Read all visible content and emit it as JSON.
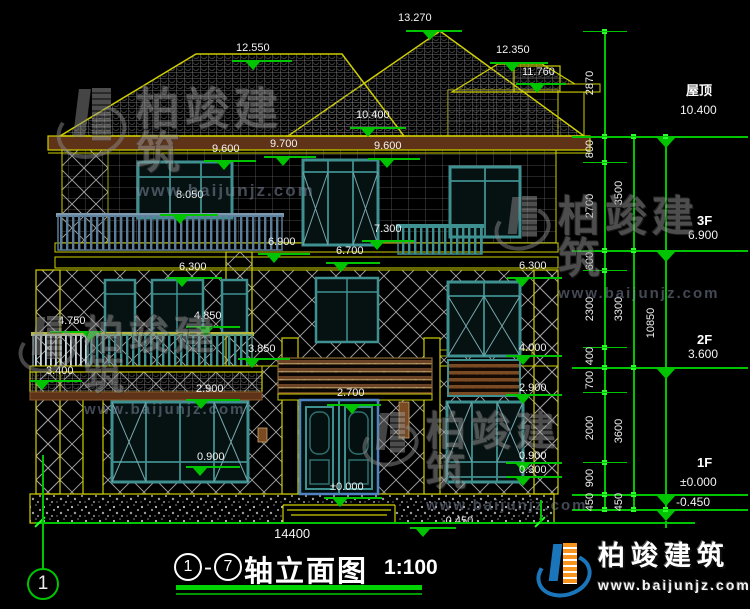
{
  "page": {
    "background": "#000000"
  },
  "colors": {
    "line_green": "#00c400",
    "tick_green": "#2aff2a",
    "cad_yellow": "#cfcf00",
    "text_white": "#f2f2f2",
    "window_teal": "#3f9090",
    "door_blue": "#4f83c2",
    "fascia_brown": "#5e3317",
    "louver_brown": "#7a4a22"
  },
  "title_block": {
    "axis_from": "1",
    "dash": "-",
    "axis_to": "7",
    "name": "轴立面图",
    "scale": "1:100"
  },
  "axis_bubble": {
    "label": "1"
  },
  "overall_dim": {
    "label": "14400"
  },
  "brand": {
    "name": "柏竣建筑",
    "url": "www.baijunjz.com"
  },
  "watermark": {
    "name": "柏竣建筑",
    "url": "www.baijunjz.com",
    "instances": [
      {
        "x": 56,
        "y": 88,
        "glyph": 72,
        "fs": 44,
        "ufs": 17
      },
      {
        "x": 18,
        "y": 316,
        "glyph": 58,
        "fs": 40,
        "ufs": 15
      },
      {
        "x": 494,
        "y": 196,
        "glyph": 56,
        "fs": 42,
        "ufs": 15
      },
      {
        "x": 362,
        "y": 412,
        "glyph": 56,
        "fs": 40,
        "ufs": 15
      }
    ]
  },
  "elevation_markers": [
    {
      "t": "13.270",
      "x": 398,
      "y": 13,
      "lx": 406,
      "ly": 30,
      "lw": 56,
      "tx": 430
    },
    {
      "t": "12.550",
      "x": 236,
      "y": 43,
      "lx": 232,
      "ly": 60,
      "lw": 60,
      "tx": 253
    },
    {
      "t": "12.350",
      "x": 496,
      "y": 45,
      "lx": 490,
      "ly": 62,
      "lw": 58,
      "tx": 512
    },
    {
      "t": "11.760",
      "x": 522,
      "y": 67,
      "lx": 516,
      "ly": 83,
      "lw": 50,
      "tx": 537
    },
    {
      "t": "10.400",
      "x": 356,
      "y": 110,
      "lx": 350,
      "ly": 127,
      "lw": 56,
      "tx": 368
    },
    {
      "t": "9.600",
      "x": 212,
      "y": 144,
      "lx": 204,
      "ly": 160,
      "lw": 52,
      "tx": 224
    },
    {
      "t": "9.700",
      "x": 270,
      "y": 139,
      "lx": 264,
      "ly": 156,
      "lw": 52,
      "tx": 283
    },
    {
      "t": "9.600",
      "x": 374,
      "y": 141,
      "lx": 368,
      "ly": 158,
      "lw": 52,
      "tx": 387
    },
    {
      "t": "8.050",
      "x": 176,
      "y": 190,
      "lx": 160,
      "ly": 214,
      "lw": 58,
      "tx": 180
    },
    {
      "t": "7.300",
      "x": 374,
      "y": 224,
      "lx": 362,
      "ly": 240,
      "lw": 52,
      "tx": 377
    },
    {
      "t": "6.900",
      "x": 268,
      "y": 237,
      "lx": 258,
      "ly": 253,
      "lw": 52,
      "tx": 274
    },
    {
      "t": "6.700",
      "x": 336,
      "y": 246,
      "lx": 326,
      "ly": 262,
      "lw": 54,
      "tx": 341
    },
    {
      "t": "6.300",
      "x": 179,
      "y": 262,
      "lx": 167,
      "ly": 277,
      "lw": 55,
      "tx": 182
    },
    {
      "t": "6.300",
      "x": 519,
      "y": 261,
      "lx": 507,
      "ly": 277,
      "lw": 55,
      "tx": 522
    },
    {
      "t": "4.750",
      "x": 58,
      "y": 316,
      "lx": 50,
      "ly": 331,
      "lw": 52,
      "tx": 90
    },
    {
      "t": "4.850",
      "x": 194,
      "y": 311,
      "lx": 186,
      "ly": 326,
      "lw": 54,
      "tx": 206
    },
    {
      "t": "3.850",
      "x": 248,
      "y": 344,
      "lx": 238,
      "ly": 358,
      "lw": 52,
      "tx": 252
    },
    {
      "t": "3.400",
      "x": 46,
      "y": 366,
      "lx": 30,
      "ly": 380,
      "lw": 52,
      "tx": 42
    },
    {
      "t": "2.900",
      "x": 196,
      "y": 384,
      "lx": 186,
      "ly": 399,
      "lw": 54,
      "tx": 201
    },
    {
      "t": "2.700",
      "x": 337,
      "y": 388,
      "lx": 327,
      "ly": 404,
      "lw": 54,
      "tx": 352
    },
    {
      "t": "4.000",
      "x": 519,
      "y": 343,
      "lx": 506,
      "ly": 355,
      "lw": 56,
      "tx": 523
    },
    {
      "t": "2.900",
      "x": 519,
      "y": 383,
      "lx": 506,
      "ly": 394,
      "lw": 56,
      "tx": 523
    },
    {
      "t": "0.900",
      "x": 197,
      "y": 452,
      "lx": 186,
      "ly": 466,
      "lw": 54,
      "tx": 200
    },
    {
      "t": "0.900",
      "x": 519,
      "y": 451,
      "lx": 506,
      "ly": 462,
      "lw": 56,
      "tx": 523
    },
    {
      "t": "0.300",
      "x": 519,
      "y": 465,
      "lx": 506,
      "ly": 476,
      "lw": 56,
      "tx": 523
    },
    {
      "t": "±0.000",
      "x": 330,
      "y": 482,
      "lx": 324,
      "ly": 497,
      "lw": 58,
      "tx": 340
    },
    {
      "t": "-0.450",
      "x": 442,
      "y": 516,
      "lx": 410,
      "ly": 527,
      "lw": 46,
      "tx": 423
    }
  ],
  "floor_levels": [
    {
      "name": "屋顶",
      "value": "10.400",
      "nx": 686,
      "ny": 84,
      "vx": 680,
      "vy": 104,
      "line_y": 136
    },
    {
      "name": "3F",
      "value": "6.900",
      "nx": 697,
      "ny": 214,
      "vx": 688,
      "vy": 229,
      "line_y": 250
    },
    {
      "name": "2F",
      "value": "3.600",
      "nx": 697,
      "ny": 333,
      "vx": 688,
      "vy": 348,
      "line_y": 367
    },
    {
      "name": "1F",
      "value": "±0.000",
      "nx": 697,
      "ny": 456,
      "vx": 680,
      "vy": 476,
      "line_y": 494
    },
    {
      "name": "",
      "value": "-0.450",
      "nx": 0,
      "ny": 0,
      "vx": 676,
      "vy": 496,
      "line_y": 509
    }
  ],
  "dimension_column": {
    "lines": [
      {
        "x": 604,
        "y1": 31,
        "y2": 509,
        "ticks": [
          31,
          136,
          162,
          250,
          270,
          347,
          367,
          392,
          462,
          494,
          509
        ],
        "labels": [
          {
            "t": "2870",
            "y": 83
          },
          {
            "t": "800",
            "y": 149
          },
          {
            "t": "2700",
            "y": 206
          },
          {
            "t": "600",
            "y": 261
          },
          {
            "t": "2300",
            "y": 309
          },
          {
            "t": "400",
            "y": 356
          },
          {
            "t": "700",
            "y": 380
          },
          {
            "t": "2000",
            "y": 428
          },
          {
            "t": "900",
            "y": 478
          },
          {
            "t": "450",
            "y": 502
          }
        ]
      },
      {
        "x": 633,
        "y1": 136,
        "y2": 509,
        "ticks": [
          136,
          250,
          367,
          494,
          509
        ],
        "labels": [
          {
            "t": "3500",
            "y": 193
          },
          {
            "t": "3300",
            "y": 309
          },
          {
            "t": "3600",
            "y": 431
          },
          {
            "t": "450",
            "y": 502
          }
        ]
      },
      {
        "x": 665,
        "y1": 136,
        "y2": 509,
        "ticks": [
          136,
          509
        ],
        "labels": [
          {
            "t": "10850",
            "y": 323
          }
        ]
      }
    ]
  },
  "baseline": {
    "ticks": [
      40,
      540
    ],
    "vlines": [
      {
        "x": 540,
        "y1": 500,
        "y2": 523
      }
    ]
  }
}
